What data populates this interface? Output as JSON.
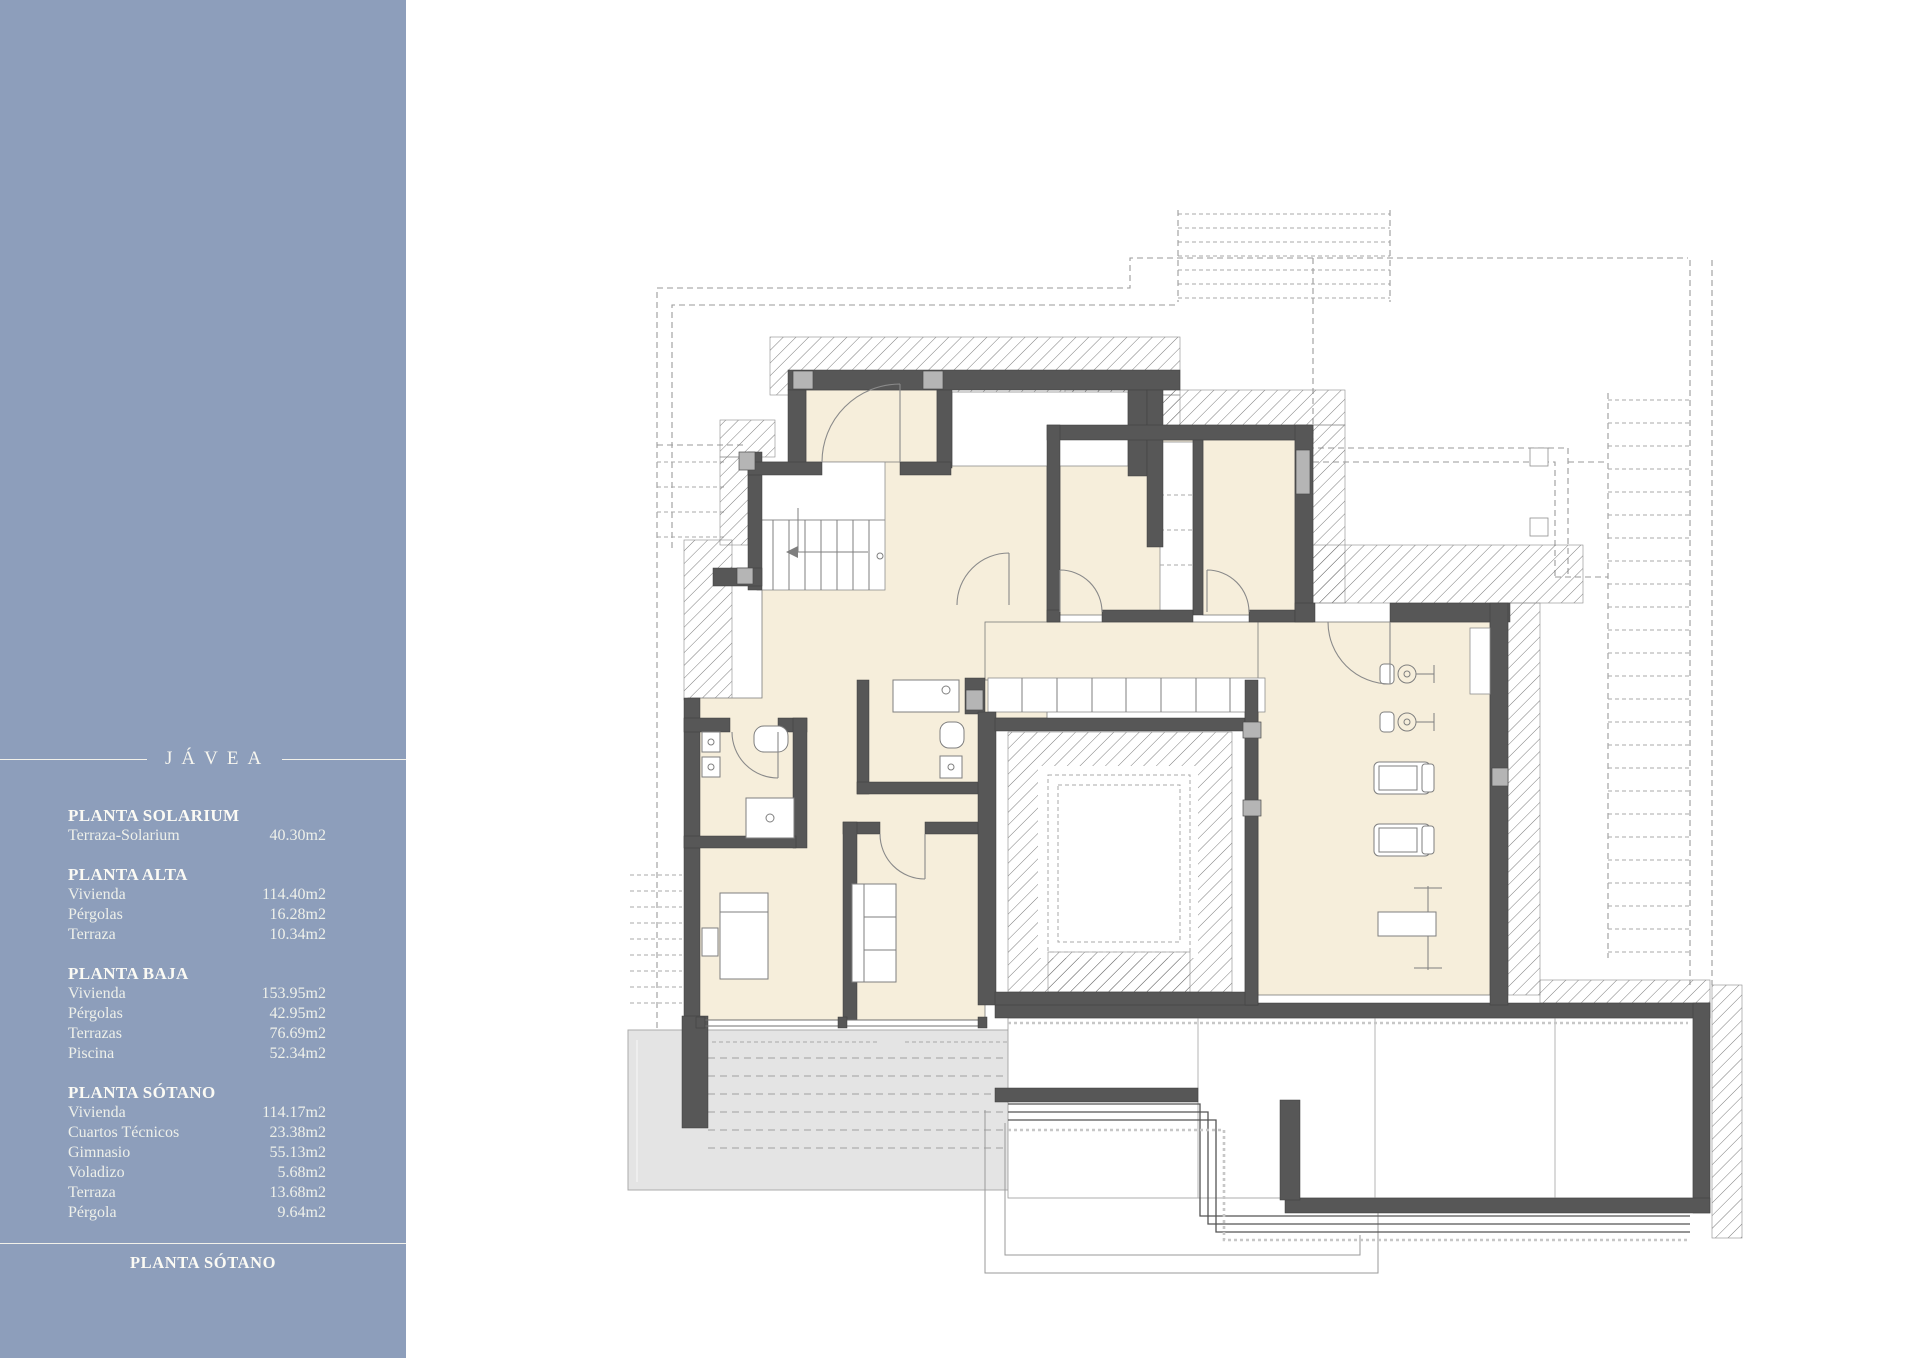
{
  "sidebar": {
    "background_color": "#8d9ebb",
    "text_color": "#f7f5ec",
    "project_title": "JÁVEA",
    "sections": [
      {
        "heading": "PLANTA SOLARIUM",
        "rows": [
          {
            "label": "Terraza-Solarium",
            "value": "40.30m2"
          }
        ]
      },
      {
        "heading": "PLANTA ALTA",
        "rows": [
          {
            "label": "Vivienda",
            "value": "114.40m2"
          },
          {
            "label": "Pérgolas",
            "value": "16.28m2"
          },
          {
            "label": "Terraza",
            "value": "10.34m2"
          }
        ]
      },
      {
        "heading": "PLANTA BAJA",
        "rows": [
          {
            "label": "Vivienda",
            "value": "153.95m2"
          },
          {
            "label": "Pérgolas",
            "value": "42.95m2"
          },
          {
            "label": "Terrazas",
            "value": "76.69m2"
          },
          {
            "label": "Piscina",
            "value": "52.34m2"
          }
        ]
      },
      {
        "heading": "PLANTA SÓTANO",
        "rows": [
          {
            "label": "Vivienda",
            "value": "114.17m2"
          },
          {
            "label": "Cuartos Técnicos",
            "value": "23.38m2"
          },
          {
            "label": "Gimnasio",
            "value": "55.13m2"
          },
          {
            "label": "Voladizo",
            "value": "5.68m2"
          },
          {
            "label": "Terraza",
            "value": "13.68m2"
          },
          {
            "label": "Pérgola",
            "value": "9.64m2"
          }
        ]
      }
    ],
    "footer_label": "PLANTA SÓTANO"
  },
  "plan": {
    "colors": {
      "wall": "#575757",
      "floor": "#f6eedb",
      "terrace": "#e4e4e4",
      "column": "#b5b5b5",
      "hatch": "#6e6e6e"
    }
  }
}
